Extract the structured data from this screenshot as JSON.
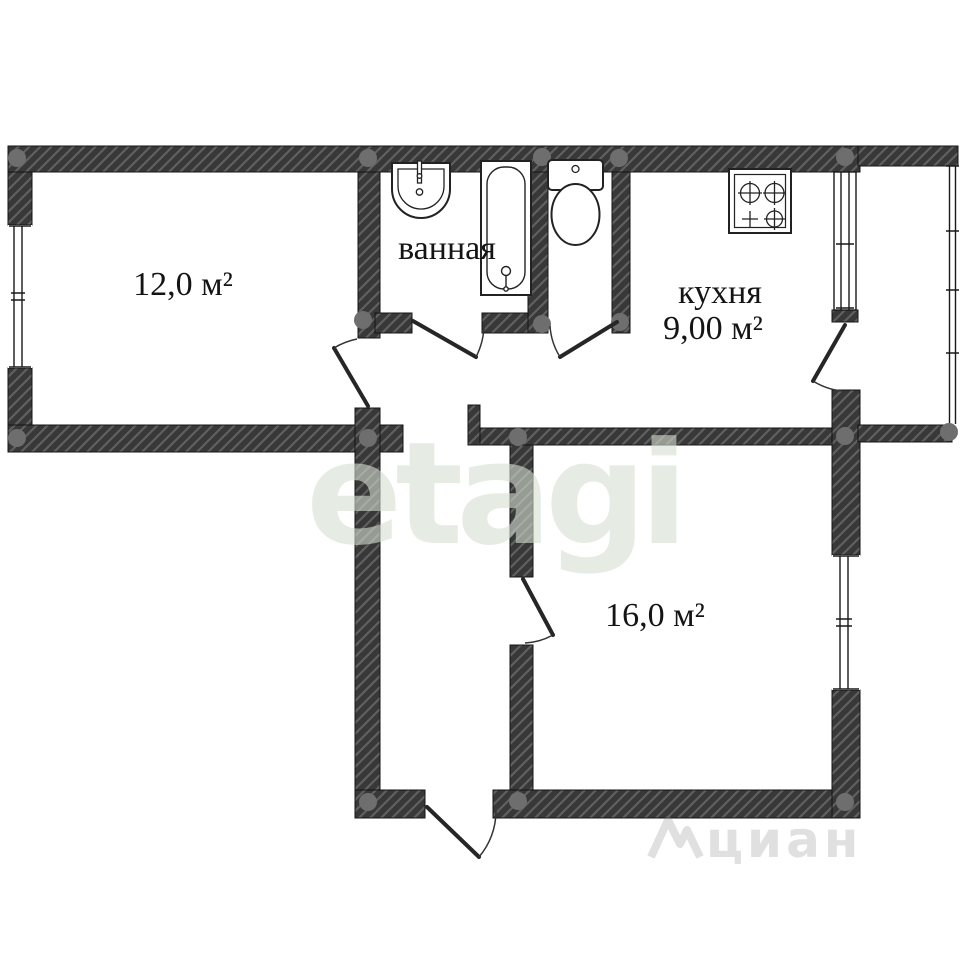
{
  "floorplan": {
    "type": "apartment-floor-plan",
    "rooms": {
      "room_12": {
        "area_label": "12,0 м²"
      },
      "bathroom": {
        "name_label": "ванная"
      },
      "kitchen": {
        "name_label": "кухня",
        "area_label": "9,00 м²"
      },
      "room_16": {
        "area_label": "16,0 м²"
      }
    },
    "fixtures": [
      {
        "name": "sink-icon",
        "room": "bathroom"
      },
      {
        "name": "bathtub-icon",
        "room": "bathroom"
      },
      {
        "name": "toilet-icon",
        "room": "wc"
      },
      {
        "name": "stove-icon",
        "room": "kitchen"
      }
    ],
    "openings": {
      "windows": 3,
      "doors": 6,
      "balcony_doors": 1
    },
    "colors": {
      "wall": "#383838",
      "wall_hatch": "#606060",
      "junction_dot": "#6e6e6e",
      "fixture_outline": "#222222",
      "label_text": "#141414",
      "watermark_brand": "#d6dfd2",
      "watermark_portal": "#8a8a8a",
      "background": "#ffffff"
    }
  },
  "watermarks": {
    "brand": "etagi",
    "portal": "циан"
  }
}
